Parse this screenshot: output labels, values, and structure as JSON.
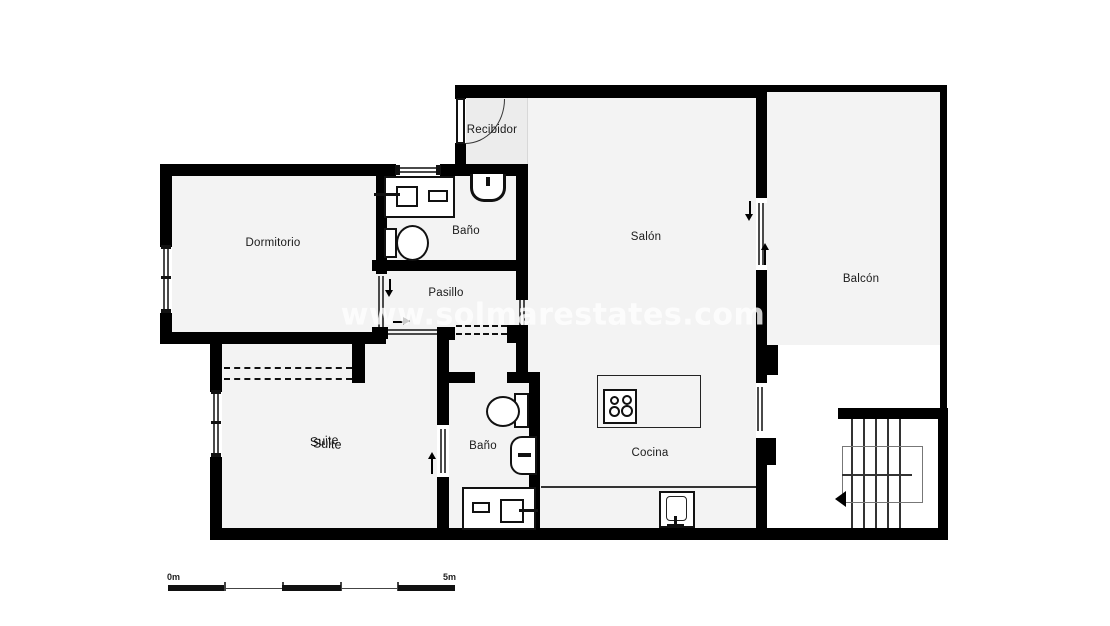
{
  "watermark": "www.solmarestates.com",
  "rooms": {
    "recibidor": {
      "label": "Recibidor"
    },
    "dormitorio": {
      "label": "Dormitorio"
    },
    "bano_top": {
      "label": "Baño"
    },
    "pasillo": {
      "label": "Pasillo"
    },
    "salon": {
      "label": "Salón"
    },
    "balcon": {
      "label": "Balcón"
    },
    "suite": {
      "label": "Suite"
    },
    "bano_bottom": {
      "label": "Baño"
    },
    "cocina": {
      "label": "Cocina"
    }
  },
  "scale_bar": {
    "start_label": "0m",
    "end_label": "5m"
  },
  "colors": {
    "wall": "#000000",
    "floor": "#f3f3f3",
    "recibidor_floor": "#ececec",
    "line": "#1a1a1a",
    "watermark": "#ffffff"
  }
}
